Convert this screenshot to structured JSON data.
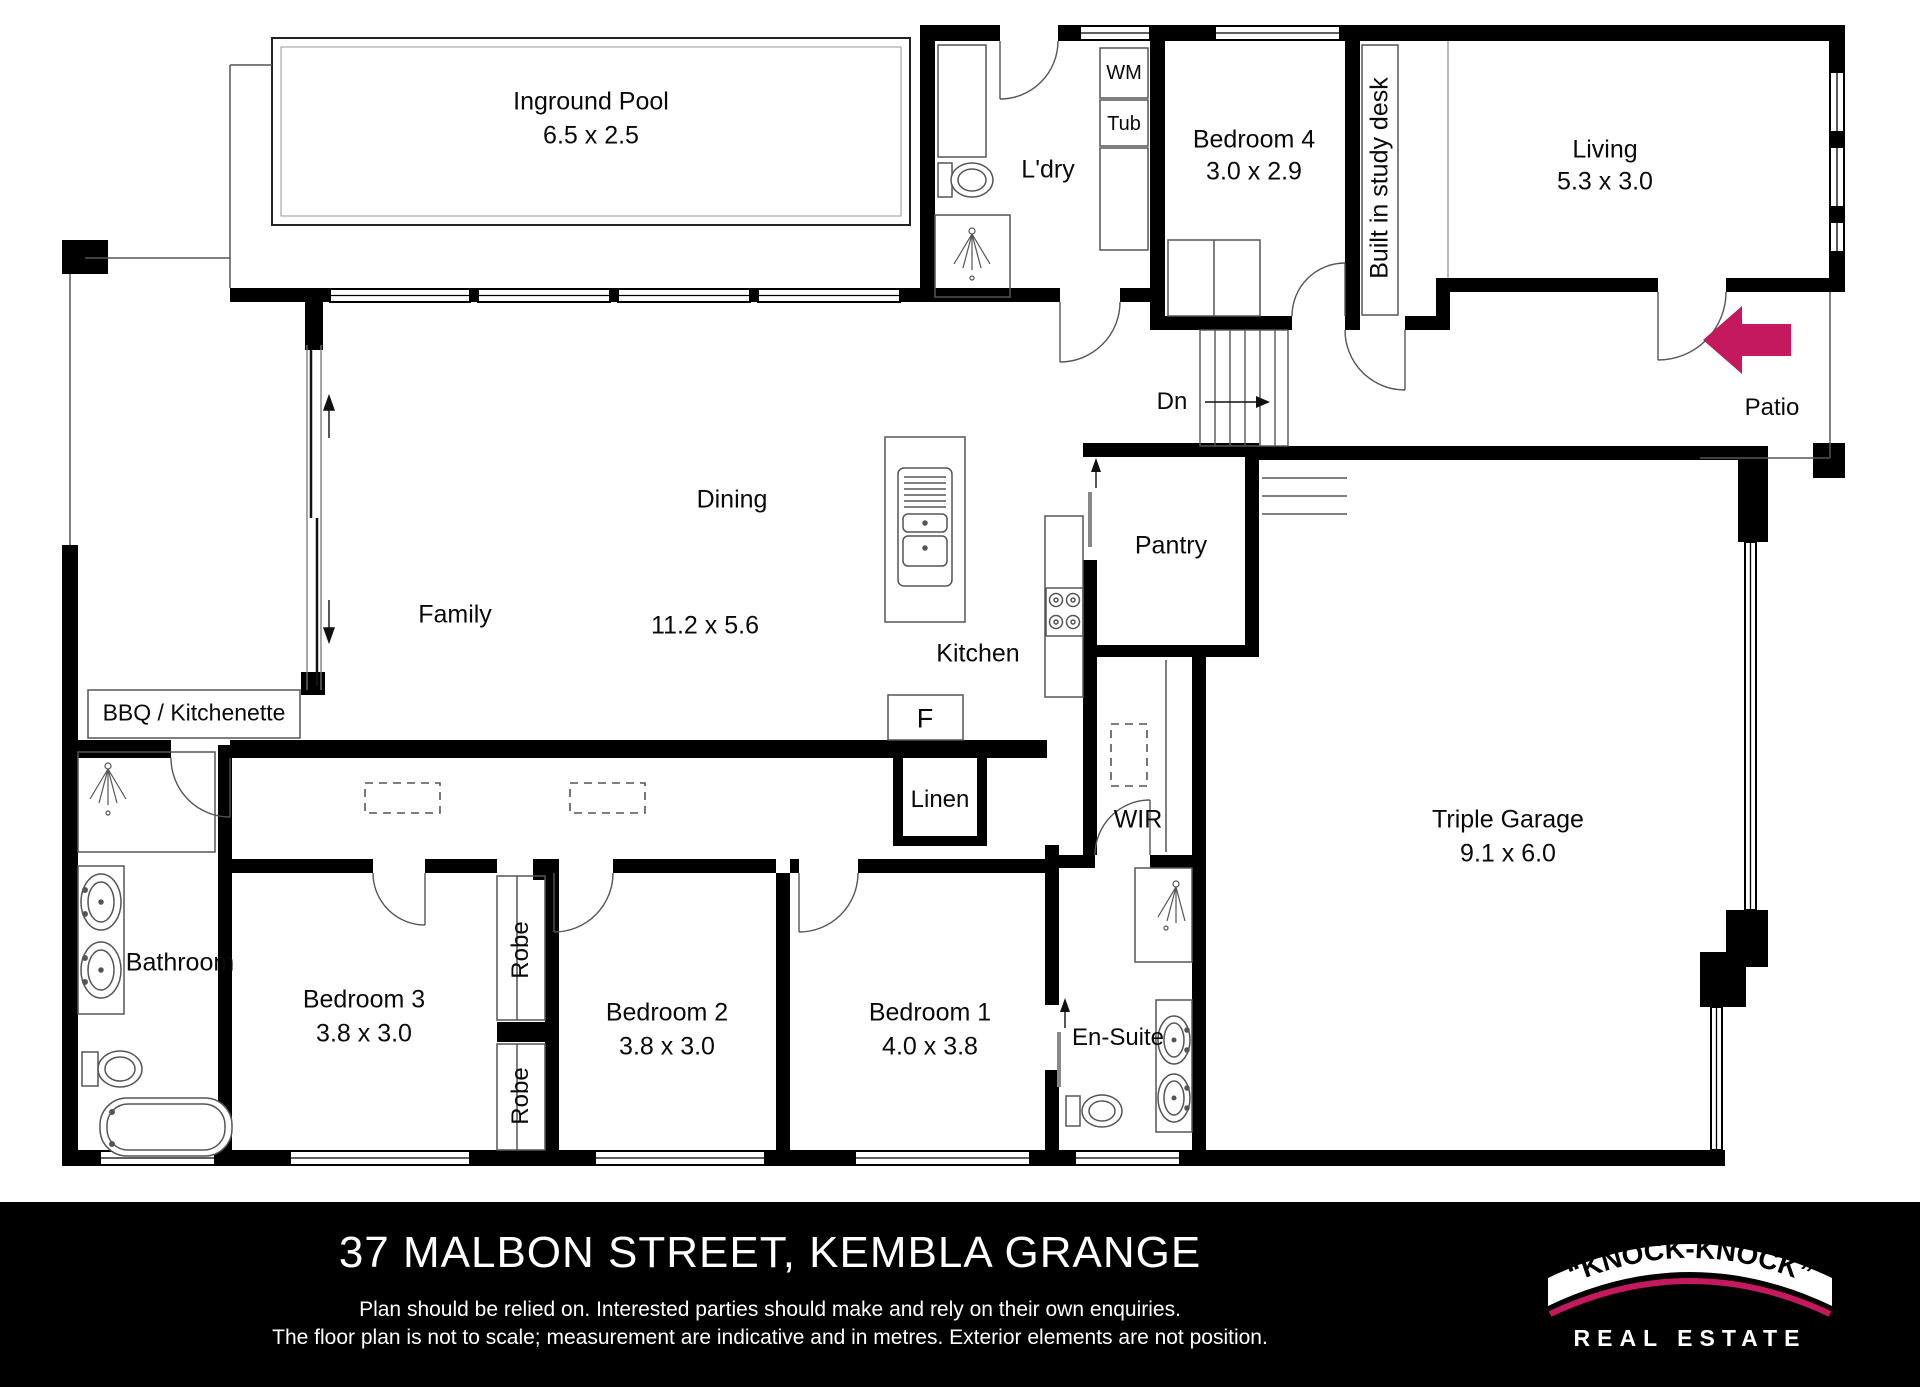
{
  "plan": {
    "rooms": {
      "pool": {
        "name": "Inground Pool",
        "dims": "6.5 x 2.5"
      },
      "laundry": {
        "name": "L'dry"
      },
      "wm": {
        "name": "WM"
      },
      "tub": {
        "name": "Tub"
      },
      "bedroom4": {
        "name": "Bedroom 4",
        "dims": "3.0 x 2.9"
      },
      "study": {
        "name": "Built in study desk"
      },
      "living": {
        "name": "Living",
        "dims": "5.3 x 3.0"
      },
      "patio": {
        "name": "Patio"
      },
      "stairs": {
        "name": "Dn"
      },
      "family": {
        "name": "Family"
      },
      "dining": {
        "name": "Dining",
        "dims": "11.2 x 5.6"
      },
      "kitchen": {
        "name": "Kitchen"
      },
      "fridge": {
        "name": "F"
      },
      "pantry": {
        "name": "Pantry"
      },
      "bbq": {
        "name": "BBQ / Kitchenette"
      },
      "bathroom": {
        "name": "Bathroom"
      },
      "linen": {
        "name": "Linen"
      },
      "wir": {
        "name": "WIR"
      },
      "bedroom3": {
        "name": "Bedroom 3",
        "dims": "3.8 x 3.0"
      },
      "robe_top": {
        "name": "Robe"
      },
      "robe_bottom": {
        "name": "Robe"
      },
      "bedroom2": {
        "name": "Bedroom 2",
        "dims": "3.8 x 3.0"
      },
      "bedroom1": {
        "name": "Bedroom 1",
        "dims": "4.0 x 3.8"
      },
      "ensuite": {
        "name": "En-Suite"
      },
      "garage": {
        "name": "Triple Garage",
        "dims": "9.1 x 6.0"
      }
    },
    "colors": {
      "wall": "#000000",
      "accent_pink": "#c5195f",
      "thin_line": "#555555"
    }
  },
  "footer": {
    "address": "37 MALBON STREET, KEMBLA GRANGE",
    "disclaimer_line1": "Plan should be relied on. Interested parties should make and rely on their own enquiries.",
    "disclaimer_line2": "The floor plan is not to scale; measurement are indicative and in metres. Exterior elements are not position.",
    "logo": {
      "brand": "“KNOCK-KNOCK”",
      "tagline": "REAL ESTATE"
    }
  }
}
